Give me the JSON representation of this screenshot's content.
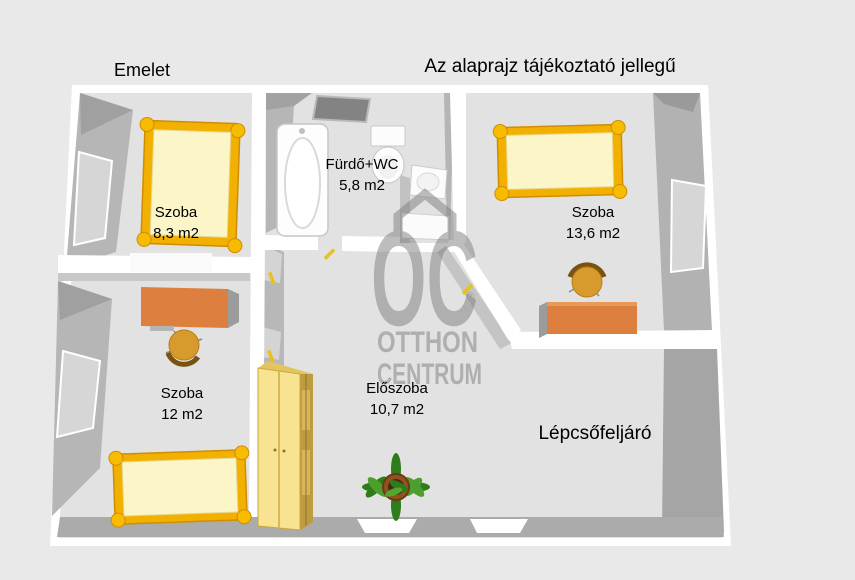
{
  "page": {
    "title": "Emelet",
    "disclaimer": "Az alaprajz tájékoztató jellegű"
  },
  "rooms": {
    "room83": {
      "name": "Szoba",
      "area": "8,3 m2"
    },
    "bathroom": {
      "name": "Fürdő+WC",
      "area": "5,8 m2"
    },
    "room136": {
      "name": "Szoba",
      "area": "13,6 m2"
    },
    "room12": {
      "name": "Szoba",
      "area": "12 m2"
    },
    "hallway": {
      "name": "Előszoba",
      "area": "10,7 m2"
    },
    "staircase": {
      "name": "Lépcsőfeljáró"
    }
  },
  "watermark": {
    "logo": "OC",
    "registered": "®",
    "brand_line1": "OTTHON",
    "brand_line2": "CENTRUM"
  },
  "colors": {
    "background": "#e9e9e9",
    "floor": "#e2e2e2",
    "wall_white": "#ffffff",
    "wall_gray": "#b5b5b5",
    "wall_dark": "#a0a0a0",
    "bottom_wall": "#ababab",
    "window_pane": "#d6d6d6",
    "bed_frame": "#f2b000",
    "bed_post": "#f7bb00",
    "mattress": "#fbf5c8",
    "desk_orange": "#dd7f3e",
    "chair_tan": "#d79a2d",
    "wardrobe_front": "#f7e392",
    "wardrobe_side": "#bd9b3f",
    "plant_green": "#2e7d1a",
    "plant_pot": "#8f5222",
    "door_marker_yellow": "#e7c21c",
    "watermark_gray": "#8f8f8f"
  }
}
